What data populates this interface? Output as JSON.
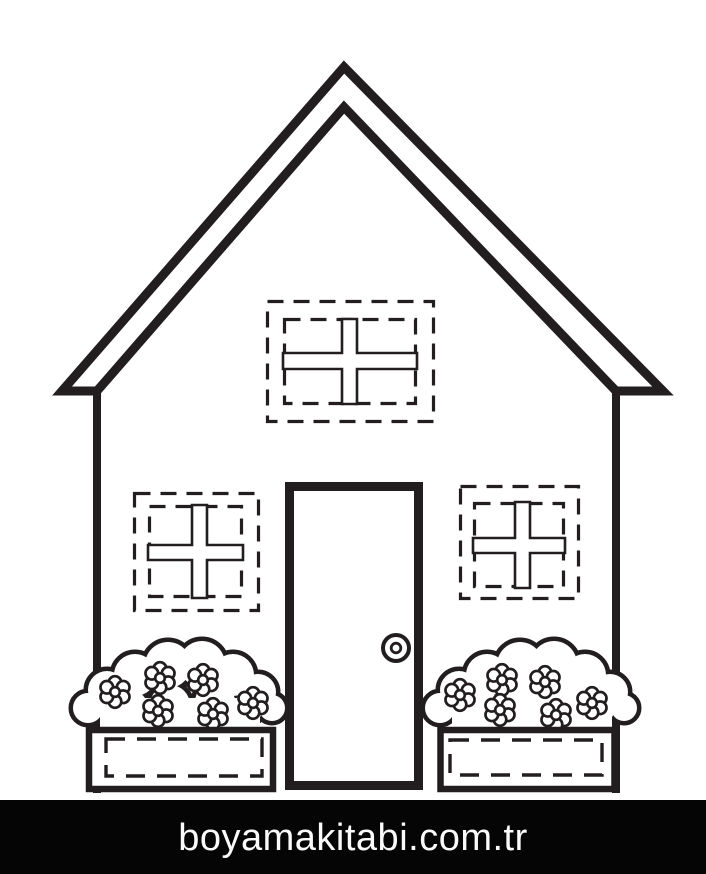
{
  "artwork": {
    "description": "Black-and-white house coloring page: triangular roof, attic window and two front windows marked with dashed cut lines, central door with round knob, and two flower boxes with blossoming bushes.",
    "line_color": "#221e1f",
    "paper_color": "#ffffff"
  },
  "footer": {
    "site_text": "boyamakitabi.com.tr",
    "bar_color": "#050505",
    "text_color": "#fafafa"
  }
}
